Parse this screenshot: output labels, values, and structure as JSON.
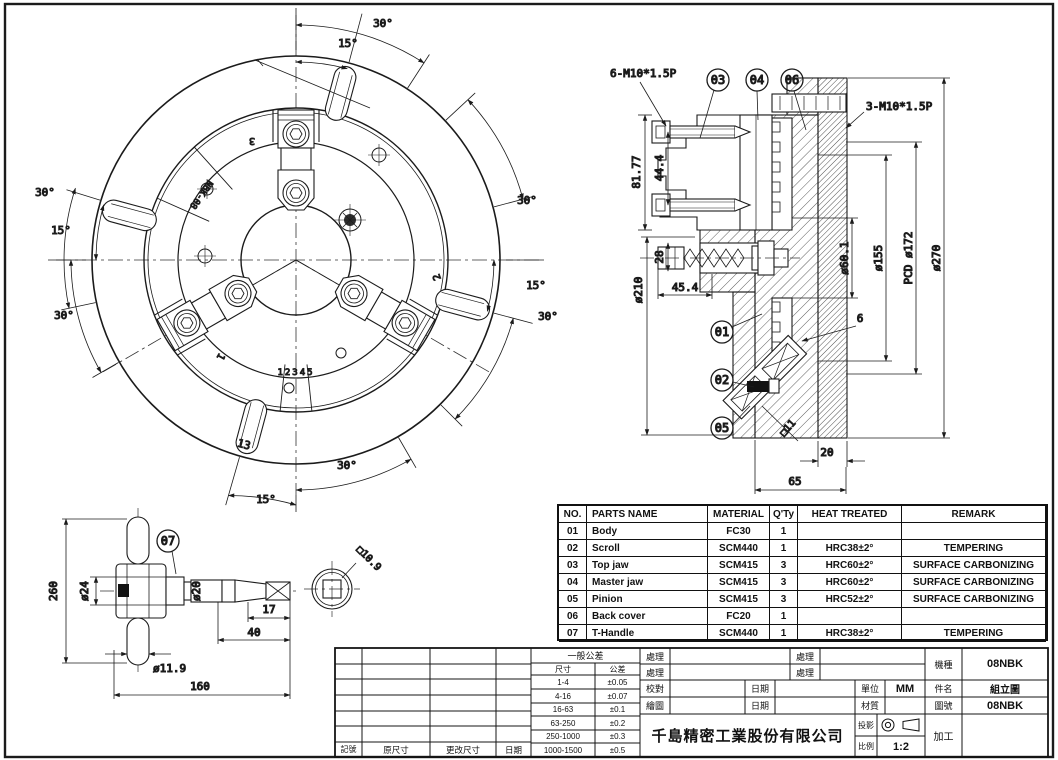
{
  "front_view": {
    "engraving": "NBK-08",
    "graduation": "12345",
    "jaw_numbers": {
      "j1": "1",
      "j2": "2",
      "j3": "3"
    },
    "dims": {
      "top_30": "30°",
      "top_15": "15°",
      "right_30_upper": "30°",
      "right_15": "15°",
      "right_30_lower": "30°",
      "bottom_30": "30°",
      "bottom_15": "15°",
      "left_30_upper": "30°",
      "left_15": "15°",
      "left_30_lower": "30°",
      "slot_width": "13"
    }
  },
  "section_view": {
    "notes": {
      "front_bolts": "6-M10*1.5P",
      "back_bolts": "3-M10*1.5P"
    },
    "balloons": {
      "b01": "01",
      "b02": "02",
      "b03": "03",
      "b04": "04",
      "b05": "05",
      "b06": "06"
    },
    "dims": {
      "jaw_height": "81.77",
      "bolt_span": "44.4",
      "body_dia": "ø210",
      "socket_span": "28",
      "boss_len": "45.4",
      "bore_dia": "ø60.1",
      "recess_dia": "ø155",
      "pcd": "PCD ø172",
      "outer_dia": "ø270",
      "tooth": "6",
      "pinion_sq": "□11",
      "back_thk": "20",
      "total_thk": "65"
    }
  },
  "t_handle_view": {
    "balloon": "07",
    "dims": {
      "length": "260",
      "hub_dia": "ø24",
      "shaft_dia": "ø20",
      "tip_len": "17",
      "end_len": "40",
      "bar_dia": "ø11.9",
      "total_len": "160",
      "square": "□10.9"
    }
  },
  "parts_table": {
    "headers": {
      "no": "NO.",
      "name": "PARTS NAME",
      "material": "MATERIAL",
      "qty": "Q'Ty",
      "heat": "HEAT TREATED",
      "remark": "REMARK"
    },
    "rows": [
      {
        "no": "01",
        "name": "Body",
        "material": "FC30",
        "qty": "1",
        "heat": "",
        "remark": ""
      },
      {
        "no": "02",
        "name": "Scroll",
        "material": "SCM440",
        "qty": "1",
        "heat": "HRC38±2°",
        "remark": "TEMPERING"
      },
      {
        "no": "03",
        "name": "Top jaw",
        "material": "SCM415",
        "qty": "3",
        "heat": "HRC60±2°",
        "remark": "SURFACE CARBONIZING"
      },
      {
        "no": "04",
        "name": "Master jaw",
        "material": "SCM415",
        "qty": "3",
        "heat": "HRC60±2°",
        "remark": "SURFACE CARBONIZING"
      },
      {
        "no": "05",
        "name": "Pinion",
        "material": "SCM415",
        "qty": "3",
        "heat": "HRC52±2°",
        "remark": "SURFACE CARBONIZING"
      },
      {
        "no": "06",
        "name": "Back cover",
        "material": "FC20",
        "qty": "1",
        "heat": "",
        "remark": ""
      },
      {
        "no": "07",
        "name": "T-Handle",
        "material": "SCM440",
        "qty": "1",
        "heat": "HRC38±2°",
        "remark": "TEMPERING"
      }
    ]
  },
  "title_block": {
    "revision": {
      "labels": {
        "mark": "記號",
        "orig": "原尺寸",
        "changed": "更改尺寸",
        "date": "日期"
      }
    },
    "tolerance": {
      "title": "一般公差",
      "dim": "尺寸",
      "tol": "公差",
      "rows": [
        [
          "1-4",
          "±0.05"
        ],
        [
          "4-16",
          "±0.07"
        ],
        [
          "16-63",
          "±0.1"
        ],
        [
          "63-250",
          "±0.2"
        ],
        [
          "250-1000",
          "±0.3"
        ],
        [
          "1000-1500",
          "±0.5"
        ]
      ]
    },
    "fields": {
      "treat1": "處理",
      "treat2": "處理",
      "treat3": "處理",
      "treat4": "處理",
      "check": "校對",
      "date1": "日期",
      "draw": "繪圖",
      "date2": "日期",
      "unit_label": "單位",
      "unit": "MM",
      "item_label": "件名",
      "item": "組立圖",
      "material_label": "材質",
      "material": "",
      "dwg_label": "圖號",
      "dwg_no": "08NBK",
      "model_label": "機種",
      "model": "08NBK",
      "projection_label": "投影",
      "scale_label": "比例",
      "scale": "1:2",
      "process": "加工",
      "company": "千島精密工業股份有限公司"
    }
  }
}
